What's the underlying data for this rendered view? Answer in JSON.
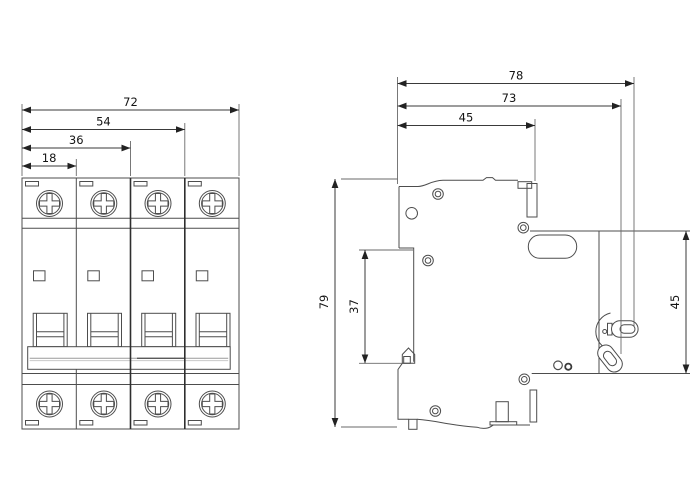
{
  "drawing": {
    "type": "technical-dimension-drawing",
    "subject": "4-pole miniature circuit breaker, front view and side view",
    "units_shown": "mm",
    "dimensions": {
      "front_total_width": "72",
      "front_width_3_modules": "54",
      "front_width_2_modules": "36",
      "front_width_1_module": "18",
      "overall_height": "79",
      "side_total_depth": "78",
      "side_depth_to_lever": "73",
      "side_body_depth": "45",
      "rail_recess_height": "37",
      "front_face_height": "45"
    },
    "colors": {
      "background": "#ffffff",
      "line": "#4d4d4d",
      "dimension_line": "#3a3a3a",
      "text": "#141414"
    }
  }
}
